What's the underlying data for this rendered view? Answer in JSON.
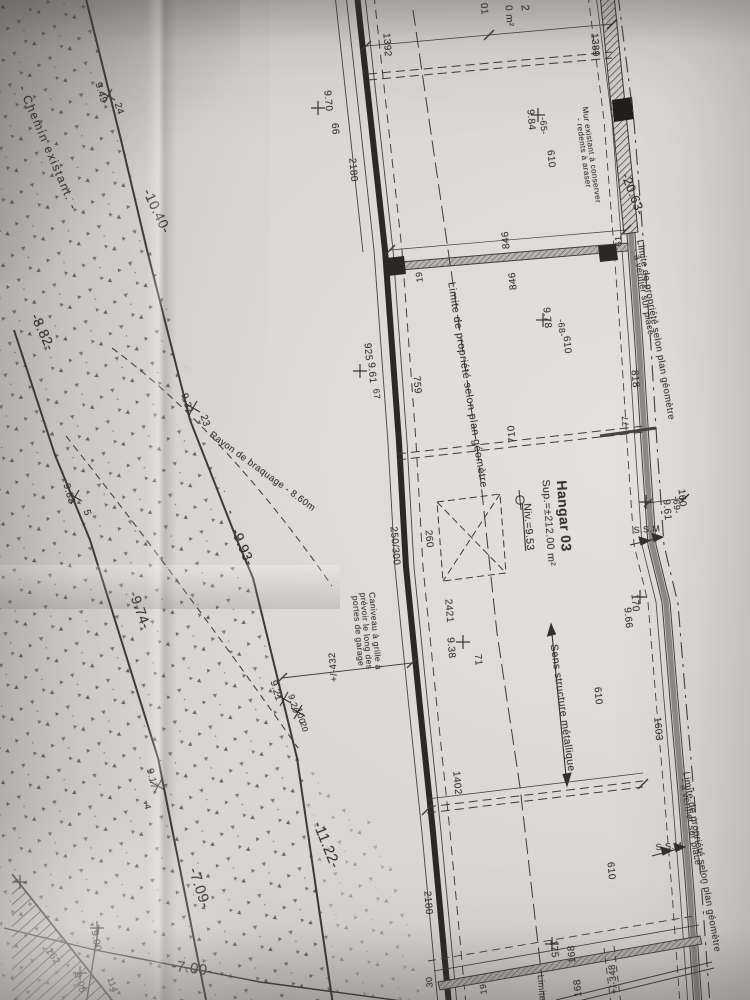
{
  "colors": {
    "paper": "#d8d5d0",
    "ink": "#34322d",
    "wall_dark": "#2a2926",
    "wall_grey": "#8e8b86"
  },
  "building": {
    "name_label": "Hangar 03",
    "area_label": "Sup.=±212.00 m²",
    "level_label": "Niv.=9.53"
  },
  "labels": [
    {
      "name": "chemin-existant-label",
      "text": "- Chemin existant. -",
      "x": 48,
      "y": 148,
      "rot": 67,
      "size": 12,
      "ls": 1.5
    },
    {
      "name": "level-10-40",
      "text": "-10.40-",
      "x": 157,
      "y": 211,
      "rot": 65,
      "size": 14
    },
    {
      "name": "level-8-82",
      "text": "-8.82-",
      "x": 43,
      "y": 332,
      "rot": 65,
      "size": 14
    },
    {
      "name": "level-9-93",
      "text": "-9.93-",
      "x": 243,
      "y": 547,
      "rot": 67,
      "size": 14
    },
    {
      "name": "level-9-74",
      "text": "-9.74-",
      "x": 140,
      "y": 610,
      "rot": 70,
      "size": 14
    },
    {
      "name": "level-11-22",
      "text": "-11.22-",
      "x": 326,
      "y": 845,
      "rot": 68,
      "size": 15
    },
    {
      "name": "level-7-09",
      "text": "-7.09-",
      "x": 199,
      "y": 888,
      "rot": 72,
      "size": 15
    },
    {
      "name": "level-7-00",
      "text": "-7.00-",
      "x": 192,
      "y": 969,
      "rot": 8,
      "size": 15
    },
    {
      "name": "rayon-braquage-label",
      "text": "Rayon de braquage - 8.60m",
      "x": 262,
      "y": 472,
      "rot": 36,
      "size": 9.5
    },
    {
      "name": "spot-9-49",
      "text": "9.49",
      "x": 100,
      "y": 93,
      "rot": 73,
      "size": 10
    },
    {
      "name": "point-24",
      "text": "24",
      "x": 118,
      "y": 109,
      "rot": 73,
      "size": 10
    },
    {
      "name": "spot-9-31",
      "text": "9.31",
      "x": 186,
      "y": 404,
      "rot": 72,
      "size": 10
    },
    {
      "name": "point-23",
      "text": "23",
      "x": 204,
      "y": 421,
      "rot": 72,
      "size": 10
    },
    {
      "name": "spot-9-33",
      "text": "9.33",
      "x": 68,
      "y": 494,
      "rot": 74,
      "size": 10
    },
    {
      "name": "point-5",
      "text": "5",
      "x": 86,
      "y": 513,
      "rot": 74,
      "size": 10
    },
    {
      "name": "spot-9-17",
      "text": "9.17",
      "x": 151,
      "y": 779,
      "rot": 76,
      "size": 10
    },
    {
      "name": "point-4",
      "text": "4",
      "x": 147,
      "y": 807,
      "rot": 76,
      "size": 9
    },
    {
      "name": "spot-9-21",
      "text": "9.21",
      "x": 275,
      "y": 691,
      "rot": 74,
      "size": 10
    },
    {
      "name": "spot-9-20",
      "text": "9.20",
      "x": 293,
      "y": 704,
      "rot": 74,
      "size": 9
    },
    {
      "name": "point-100",
      "text": "100",
      "x": 300,
      "y": 716,
      "rot": 74,
      "size": 9
    },
    {
      "name": "point-20",
      "text": "20",
      "x": 304,
      "y": 727,
      "rot": 74,
      "size": 8.5
    },
    {
      "name": "spot-9-00",
      "text": "9.00",
      "x": 95,
      "y": 941,
      "rot": 80,
      "size": 10
    },
    {
      "name": "spot-9-05",
      "text": "9.05",
      "x": 79,
      "y": 983,
      "rot": 74,
      "size": 10
    },
    {
      "name": "point-114",
      "text": "114",
      "x": 112,
      "y": 985,
      "rot": 70,
      "size": 9
    },
    {
      "name": "point-162",
      "text": "162",
      "x": 52,
      "y": 957,
      "rot": 55,
      "size": 10
    },
    {
      "name": "dim-1392",
      "text": "1392",
      "x": 386,
      "y": 45,
      "rot": 86,
      "size": 10
    },
    {
      "name": "dim-1389",
      "text": "1389",
      "x": 594,
      "y": 45,
      "rot": 86,
      "size": 10
    },
    {
      "name": "dim-2180-top",
      "text": "2180",
      "x": 352,
      "y": 170,
      "rot": 85,
      "size": 10
    },
    {
      "name": "spot-9-70",
      "text": "9.70",
      "x": 327,
      "y": 101,
      "rot": 85,
      "size": 10
    },
    {
      "name": "point-66",
      "text": "66",
      "x": 334,
      "y": 129,
      "rot": 85,
      "size": 10
    },
    {
      "name": "spot-9-84",
      "text": "9.84",
      "x": 530,
      "y": 120,
      "rot": 85,
      "size": 10
    },
    {
      "name": "point-65",
      "text": "-65-",
      "x": 543,
      "y": 126,
      "rot": 85,
      "size": 9
    },
    {
      "name": "dim-610-a",
      "text": "610",
      "x": 550,
      "y": 159,
      "rot": 85,
      "size": 10
    },
    {
      "name": "spot-9-78",
      "text": "9.78",
      "x": 546,
      "y": 318,
      "rot": 85,
      "size": 10
    },
    {
      "name": "point-68",
      "text": "-68-",
      "x": 561,
      "y": 328,
      "rot": 85,
      "size": 9
    },
    {
      "name": "dim-610-b",
      "text": "610",
      "x": 566,
      "y": 345,
      "rot": 85,
      "size": 10
    },
    {
      "name": "dim-925",
      "text": "925",
      "x": 367,
      "y": 352,
      "rot": 85,
      "size": 10
    },
    {
      "name": "spot-9-61-west",
      "text": "9.61",
      "x": 371,
      "y": 373,
      "rot": 85,
      "size": 10
    },
    {
      "name": "point-67",
      "text": "67",
      "x": 376,
      "y": 394,
      "rot": 85,
      "size": 9
    },
    {
      "name": "dim-759",
      "text": "759",
      "x": 416,
      "y": 385,
      "rot": 85,
      "size": 10
    },
    {
      "name": "dim-846-a",
      "text": "846",
      "x": 507,
      "y": 240,
      "rot": -95,
      "size": 10
    },
    {
      "name": "dim-846-b",
      "text": "846",
      "x": 514,
      "y": 281,
      "rot": -95,
      "size": 10
    },
    {
      "name": "dim-19-a",
      "text": "19",
      "x": 420,
      "y": 277,
      "rot": -95,
      "size": 9
    },
    {
      "name": "dim-61",
      "text": "61",
      "x": 619,
      "y": 241,
      "rot": -95,
      "size": 9
    },
    {
      "name": "dim-818",
      "text": "818",
      "x": 634,
      "y": 379,
      "rot": 85,
      "size": 10
    },
    {
      "name": "dim-710",
      "text": "710",
      "x": 513,
      "y": 434,
      "rot": -95,
      "size": 10
    },
    {
      "name": "dim-77",
      "text": "77",
      "x": 626,
      "y": 421,
      "rot": -95,
      "size": 9
    },
    {
      "name": "limite-propriete-interior",
      "text": "Limite de propriété selon plan géomètre",
      "x": 467,
      "y": 385,
      "rot": 81,
      "size": 10.5,
      "ls": 0.6
    },
    {
      "name": "hangar-name",
      "text": "Hangar 03",
      "x": 564,
      "y": 516,
      "rot": 86,
      "size": 14,
      "bold": true
    },
    {
      "name": "hangar-area",
      "text": "Sup.=±212.00 m²",
      "x": 548,
      "y": 523,
      "rot": 86,
      "size": 10.5
    },
    {
      "name": "hangar-level",
      "text": "Niv.=9.53",
      "x": 528,
      "y": 527,
      "rot": 86,
      "size": 10.5,
      "underline": true
    },
    {
      "name": "dim-250-300",
      "text": "250/300",
      "x": 394,
      "y": 546,
      "rot": 85,
      "size": 10
    },
    {
      "name": "dim-260",
      "text": "260",
      "x": 428,
      "y": 539,
      "rot": 85,
      "size": 10
    },
    {
      "name": "dim-2421",
      "text": "2421",
      "x": 448,
      "y": 611,
      "rot": 85,
      "size": 10
    },
    {
      "name": "spot-9-38",
      "text": "9.38",
      "x": 450,
      "y": 648,
      "rot": 85,
      "size": 10
    },
    {
      "name": "point-71",
      "text": "71",
      "x": 477,
      "y": 660,
      "rot": 85,
      "size": 10
    },
    {
      "name": "caniveau-line1",
      "text": "Caniveau à grille à",
      "x": 375,
      "y": 631,
      "rot": 85,
      "size": 8.5
    },
    {
      "name": "caniveau-line2",
      "text": "prévoir le long des",
      "x": 366,
      "y": 631,
      "rot": 85,
      "size": 8.5
    },
    {
      "name": "caniveau-line3",
      "text": "portes de garage",
      "x": 358,
      "y": 631,
      "rot": 85,
      "size": 8.5
    },
    {
      "name": "dim-432",
      "text": "+/-432",
      "x": 334,
      "y": 667,
      "rot": -95,
      "size": 9.5
    },
    {
      "name": "sens-structure-label",
      "text": "Sens structure métallique",
      "x": 562,
      "y": 708,
      "rot": 82,
      "size": 10.5
    },
    {
      "name": "dim-610-c",
      "text": "610",
      "x": 597,
      "y": 696,
      "rot": 85,
      "size": 10
    },
    {
      "name": "dim-1402",
      "text": "1402",
      "x": 456,
      "y": 783,
      "rot": 85,
      "size": 10
    },
    {
      "name": "dim-1603",
      "text": "1603",
      "x": 657,
      "y": 729,
      "rot": 85,
      "size": 10
    },
    {
      "name": "dim-160",
      "text": "160",
      "x": 681,
      "y": 498,
      "rot": 85,
      "size": 10
    },
    {
      "name": "spot-9-61-east",
      "text": "9.61",
      "x": 666,
      "y": 510,
      "rot": 85,
      "size": 10
    },
    {
      "name": "point-69",
      "text": "-69-",
      "x": 676,
      "y": 505,
      "rot": 85,
      "size": 9
    },
    {
      "name": "ssm-top-label",
      "text": "S.S.M",
      "x": 647,
      "y": 530,
      "rot": -4,
      "size": 9
    },
    {
      "name": "ssm-bottom-label",
      "text": "S.S.M",
      "x": 669,
      "y": 847,
      "rot": -4,
      "size": 9
    },
    {
      "name": "dim-170",
      "text": "170",
      "x": 634,
      "y": 603,
      "rot": 85,
      "size": 10
    },
    {
      "name": "spot-9-66",
      "text": "9.66",
      "x": 627,
      "y": 618,
      "rot": 85,
      "size": 10
    },
    {
      "name": "dim-20-63",
      "text": "-20.63-",
      "x": 633,
      "y": 194,
      "rot": 69,
      "size": 13
    },
    {
      "name": "mur-existant-line1",
      "text": "Mur existant à conserver",
      "x": 591,
      "y": 155,
      "rot": 82,
      "size": 8
    },
    {
      "name": "mur-existant-line2",
      "text": "- redents à araser",
      "x": 583,
      "y": 153,
      "rot": 82,
      "size": 8
    },
    {
      "name": "limite-east-top-line1",
      "text": "Limite de propriété selon plan géomètre",
      "x": 655,
      "y": 330,
      "rot": 80,
      "size": 9.5
    },
    {
      "name": "limite-east-top-line2",
      "text": "- à vérifier sur place",
      "x": 643,
      "y": 292,
      "rot": 80,
      "size": 9
    },
    {
      "name": "limite-east-bottom-line1",
      "text": "Limite de propriété selon plan géomètre",
      "x": 701,
      "y": 862,
      "rot": 80,
      "size": 9.5
    },
    {
      "name": "limite-east-bottom-line2",
      "text": "- à vérifier sur place",
      "x": 690,
      "y": 822,
      "rot": 80,
      "size": 9
    },
    {
      "name": "dim-2180-bottom",
      "text": "2180",
      "x": 427,
      "y": 903,
      "rot": 85,
      "size": 10
    },
    {
      "name": "dim-610-d",
      "text": "610",
      "x": 610,
      "y": 871,
      "rot": 85,
      "size": 10
    },
    {
      "name": "dim-175",
      "text": "175",
      "x": 553,
      "y": 949,
      "rot": 85,
      "size": 10
    },
    {
      "name": "dim-168-a",
      "text": "168",
      "x": 573,
      "y": 954,
      "rot": -95,
      "size": 10
    },
    {
      "name": "dim-168-b",
      "text": "168",
      "x": 579,
      "y": 988,
      "rot": -95,
      "size": 10
    },
    {
      "name": "dim-30",
      "text": "30",
      "x": 430,
      "y": 982,
      "rot": -95,
      "size": 9
    },
    {
      "name": "dim-19-b",
      "text": "19",
      "x": 484,
      "y": 989,
      "rot": -95,
      "size": 9
    },
    {
      "name": "dim-348",
      "text": "+/-348",
      "x": 614,
      "y": 979,
      "rot": -95,
      "size": 9.5
    },
    {
      "name": "limite-bottom-fragment",
      "text": "Limite",
      "x": 541,
      "y": 988,
      "rot": 85,
      "size": 9
    },
    {
      "name": "top-edge-fragment-2",
      "text": "2",
      "x": 524,
      "y": 8,
      "rot": 85,
      "size": 11
    },
    {
      "name": "top-edge-fragment-m2",
      "text": "0 m²",
      "x": 508,
      "y": 16,
      "rot": 85,
      "size": 10
    },
    {
      "name": "top-edge-fragment-01",
      "text": "01",
      "x": 483,
      "y": 9,
      "rot": 85,
      "size": 10
    }
  ]
}
